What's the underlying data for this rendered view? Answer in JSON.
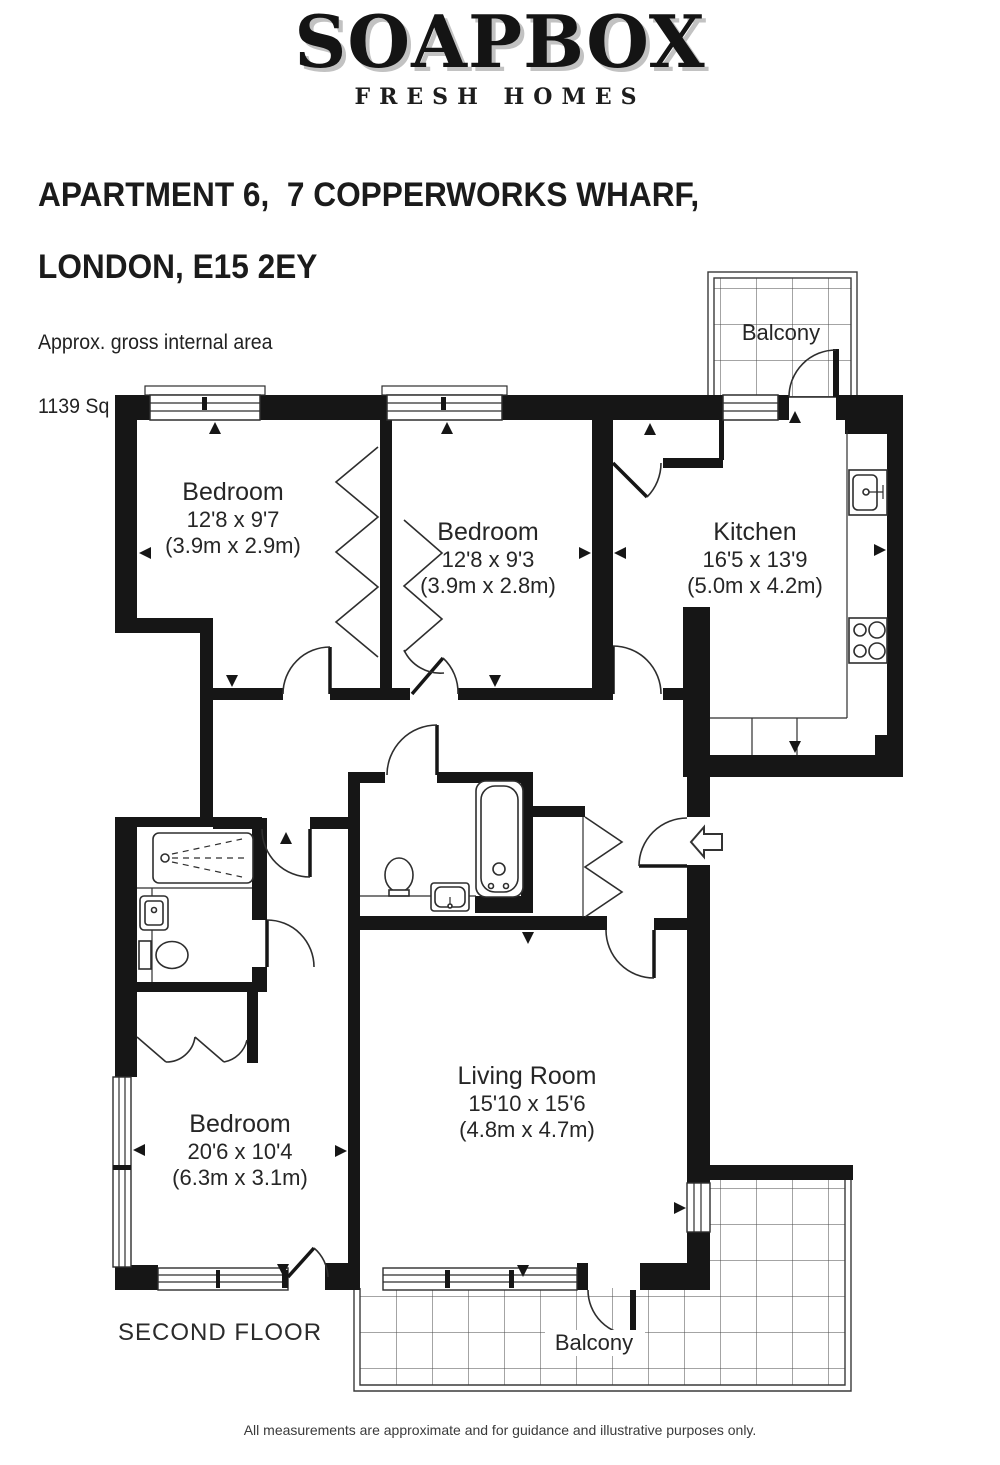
{
  "brand": {
    "logo": "SOAPBOX",
    "tagline": "FRESH HOMES"
  },
  "header": {
    "address_line1": "APARTMENT 6,  7 COPPERWORKS WHARF,",
    "address_line2": "LONDON, E15 2EY",
    "area_label": "Approx. gross internal area",
    "area_value": "1139 Sq Ft. / 105.8 Sq M."
  },
  "floor_plan": {
    "floor_label": "SECOND FLOOR",
    "rooms": {
      "bedroom1": {
        "name": "Bedroom",
        "dims_imperial": "12'8 x 9'7",
        "dims_metric": "(3.9m x 2.9m)"
      },
      "bedroom2": {
        "name": "Bedroom",
        "dims_imperial": "12'8 x 9'3",
        "dims_metric": "(3.9m x 2.8m)"
      },
      "kitchen": {
        "name": "Kitchen",
        "dims_imperial": "16'5 x 13'9",
        "dims_metric": "(5.0m x 4.2m)"
      },
      "bedroom3": {
        "name": "Bedroom",
        "dims_imperial": "20'6 x 10'4",
        "dims_metric": "(6.3m x 3.1m)"
      },
      "living_room": {
        "name": "Living Room",
        "dims_imperial": "15'10 x 15'6",
        "dims_metric": "(4.8m x 4.7m)"
      }
    },
    "balcony_top_label": "Balcony",
    "balcony_bottom_label": "Balcony",
    "symbols": [
      "bathtub",
      "shower",
      "toilet",
      "basin",
      "kitchen-sink",
      "hob",
      "wardrobe",
      "entry-arrow"
    ]
  },
  "footer": {
    "disclaimer": "All measurements are approximate and for guidance and illustrative purposes only."
  },
  "colors": {
    "wall": "#161616",
    "line": "#2e2e2e",
    "grid_line": "#4a4a4a",
    "logo_shadow": "#c2c2c2",
    "text": "#262626"
  }
}
